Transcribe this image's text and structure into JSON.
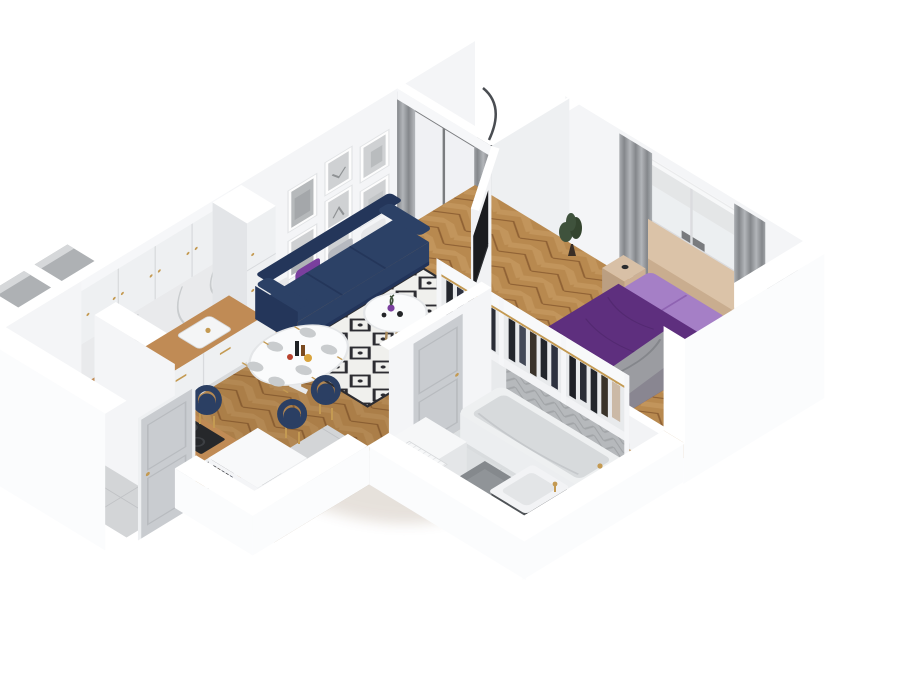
{
  "meta": {
    "description": "3D isometric cutaway render of a one-bedroom apartment floor plan on a white background, viewed from the south corner",
    "view": "axonometric-birdseye",
    "canvas": {
      "width": 920,
      "height": 700
    }
  },
  "palette": {
    "background": "#ffffff",
    "wall_white": "#f6f7f9",
    "wall_top": "#ffffff",
    "wood_floor": "#b8894f",
    "wood_chevron_light": "#c2955c",
    "wood_chevron_dark": "#8f6134",
    "tile_gray": "#d3d5d7",
    "bath_tile": "#dde0e2",
    "wall_tile_gray": "#b6b9bc",
    "balcony_plank": "#d0d1d3",
    "rug_base": "#f0f0ed",
    "rug_pattern": "#2c2c31",
    "sofa_navy": "#2c4166",
    "sofa_navy_dark": "#24365a",
    "cushion_white": "#e7e8ea",
    "cushion_gray": "#b7bac0",
    "cushion_purple": "#7a3f9e",
    "chair_navy": "#2b3f63",
    "gold_accent": "#c49a52",
    "table_white": "#fafbfc",
    "duvet_purple": "#5e2f7e",
    "duvet_light_purple": "#a57fc6",
    "throw_gray": "#9b9ca1",
    "headboard_tan": "#c9ad8f",
    "nightstand_tan": "#cdb094",
    "curtain_gray": "#84878b",
    "curtain_gray_light": "#b2b5b9",
    "sheer_white": "#f5f7f8",
    "tv_black": "#1b1c1f",
    "railing_dark": "#3f4246",
    "hanging_chair_dark": "#33363b",
    "clothes_dark": "#23262c",
    "clothes_brown": "#3a332a",
    "garment_beige": "#cbb9a6",
    "cabinet_white": "#eef0f2",
    "marble_backsplash": "#e9eaec",
    "counter_wood": "#c08b55",
    "cooktop_black": "#26282b",
    "tub_white": "#eef0f1",
    "tub_inner": "#d7dadc",
    "sink_cabinet_dark": "#4e5256",
    "door_gray": "#c9ccd0",
    "bath_mat_gray": "#85898d",
    "plant_green": "#3f523c",
    "art_gray": "#cfd1d3",
    "glass_tint": "#d3d8dc",
    "floor_shadow": "#6a4a28"
  },
  "scene": {
    "rooms": [
      {
        "name": "kitchen",
        "objects": [
          "upper-cabinets",
          "marble-backsplash",
          "base-cabinets",
          "wood-countertop",
          "kitchen-sink",
          "cooktop",
          "tall-cabinet",
          "record-box",
          "bookshelf-sideboard"
        ]
      },
      {
        "name": "living-dining-room",
        "objects": [
          "gallery-picture-frames",
          "navy-sofa",
          "throw-pillows",
          "diamond-rug",
          "coffee-table",
          "purple-vase",
          "dining-table",
          "dining-chairs",
          "tv-panel",
          "balcony-door",
          "curtains"
        ]
      },
      {
        "name": "balcony",
        "objects": [
          "hanging-egg-chair",
          "railing",
          "plank-floor",
          "sliding-glass-door"
        ]
      },
      {
        "name": "bedroom",
        "objects": [
          "double-bed-purple-duvet",
          "pillow-section",
          "gray-throw",
          "nightstands",
          "window-curtains",
          "radiator",
          "potted-plant"
        ]
      },
      {
        "name": "wardrobe",
        "objects": [
          "open-clothes-rail",
          "hanging-garments",
          "gold-hangers"
        ]
      },
      {
        "name": "bathroom",
        "objects": [
          "bathtub",
          "gold-faucet",
          "sink-vanity",
          "bath-mat",
          "towel-radiator",
          "herringbone-wall-tile",
          "bathroom-door",
          "round-rug",
          "white-cabinet"
        ]
      },
      {
        "name": "hallway",
        "objects": [
          "gray-floor-tiles",
          "entry-door",
          "ventilation-shafts"
        ]
      }
    ]
  }
}
